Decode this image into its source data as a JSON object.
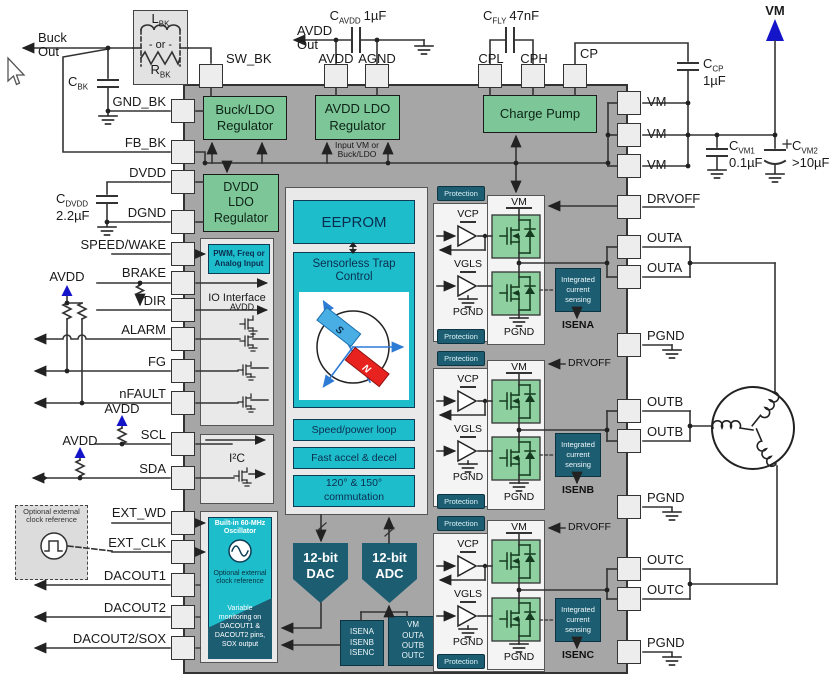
{
  "colors": {
    "green": "#7dc698",
    "cyan": "#1ebdcc",
    "teal": "#1d5d72",
    "chip_gray": "#a6a6a6",
    "supply_blue": "#1414c8",
    "axis_blue": "#2e7bd6",
    "rotor_red": "#e8231f",
    "rotor_blue": "#49aee3"
  },
  "pins": {
    "top": [
      "SW_BK",
      "AVDD",
      "AGND",
      "CPL",
      "CPH",
      "CP"
    ],
    "left": [
      "GND_BK",
      "FB_BK",
      "DVDD",
      "DGND",
      "SPEED/WAKE",
      "BRAKE",
      "DIR",
      "ALARM",
      "FG",
      "nFAULT",
      "SCL",
      "SDA",
      "EXT_WD",
      "EXT_CLK",
      "DACOUT1",
      "DACOUT2",
      "DACOUT2/SOX"
    ],
    "right": [
      "VM",
      "VM",
      "VM",
      "DRVOFF",
      "OUTA",
      "OUTA",
      "PGND",
      "OUTB",
      "OUTB",
      "PGND",
      "OUTC",
      "OUTC",
      "PGND"
    ]
  },
  "rails": {
    "buck_out": "Buck\nOut",
    "avdd_out": "AVDD\nOut",
    "vm": "VM",
    "avdd": "AVDD"
  },
  "components": {
    "l_bk": {
      "base": "L",
      "sub": "BK"
    },
    "or": "- or -",
    "r_bk": {
      "base": "R",
      "sub": "BK"
    },
    "c_bk": {
      "base": "C",
      "sub": "BK"
    },
    "c_avdd": {
      "base": "C",
      "sub": "AVDD",
      "value": "1µF"
    },
    "c_fly": {
      "base": "C",
      "sub": "FLY",
      "value": "47nF"
    },
    "c_cp": {
      "base": "C",
      "sub": "CP",
      "value": "1µF"
    },
    "c_vm1": {
      "base": "C",
      "sub": "VM1",
      "value": "0.1µF"
    },
    "c_vm2": {
      "base": "C",
      "sub": "VM2",
      "value": ">10µF"
    },
    "c_dvdd": {
      "base": "C",
      "sub": "DVDD",
      "value": "2.2µF"
    }
  },
  "clock_ref": "Optional external\nclock reference",
  "blocks": {
    "buck_ldo": "Buck/LDO\nRegulator",
    "avdd_ldo": "AVDD LDO\nRegulator",
    "charge_pump": "Charge Pump",
    "dvdd_ldo": "DVDD\nLDO\nRegulator",
    "input_note": "Input VM or\nBuck/LDO",
    "pwm": "PWM, Freq or\nAnalog Input",
    "io": "IO Interface",
    "i2c": "I²C",
    "eeprom": "EEPROM",
    "trap": "Sensorless Trap\nControl",
    "speed": "Speed/power loop",
    "accel": "Fast accel & decel",
    "comm": "120° & 150°\ncommutation",
    "dac": "12-bit\nDAC",
    "adc": "12-bit\nADC",
    "isen_group": "ISENA\nISENB\nISENC",
    "adc_inputs": "VM\nOUTA\nOUTB\nOUTC",
    "osc": "Built-in 60-MHz\nOscillator",
    "osc_ref": "Optional external\nclock reference",
    "monitor": "Variable\nmonitoring on\nDACOUT1 &\nDACOUT2 pins,\nSOX output",
    "protection": "Protection",
    "ics": "Integrated\ncurrent\nsensing"
  },
  "driver": {
    "vm": "VM",
    "vcp": "VCP",
    "vgls": "VGLS",
    "pgnd": "PGND",
    "drvoff": "DRVOFF",
    "isena": "ISENA",
    "isenb": "ISENB",
    "isenc": "ISENC"
  },
  "rotor": {
    "s": "S",
    "n": "N"
  }
}
